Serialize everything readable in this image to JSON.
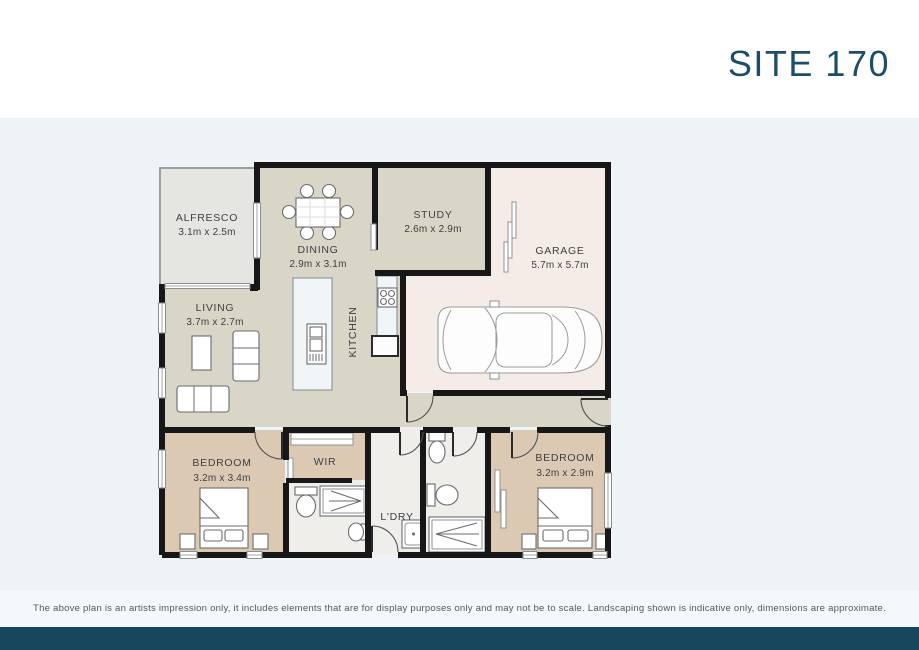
{
  "header": {
    "site_label": "SITE 170"
  },
  "plan": {
    "rooms": [
      {
        "name": "ALFRESCO",
        "dims": "3.1m x 2.5m"
      },
      {
        "name": "DINING",
        "dims": "2.9m x 3.1m"
      },
      {
        "name": "STUDY",
        "dims": "2.6m x 2.9m"
      },
      {
        "name": "GARAGE",
        "dims": "5.7m x 5.7m"
      },
      {
        "name": "LIVING",
        "dims": "3.7m x 2.7m"
      },
      {
        "name": "KITCHEN",
        "dims": ""
      },
      {
        "name": "BEDROOM",
        "dims": "3.2m x 3.4m"
      },
      {
        "name": "WIR",
        "dims": ""
      },
      {
        "name": "L'DRY",
        "dims": ""
      },
      {
        "name": "BEDROOM",
        "dims": "3.2m x 2.9m"
      }
    ]
  },
  "footer": {
    "disclaimer": "The above plan is an artists impression only, it includes elements that are for display purposes only and may not be to scale. Landscaping shown is indicative only, dimensions are approximate."
  },
  "colors": {
    "accent": "#1e4d68",
    "footer_bar": "#16475d",
    "plan_background": "#edf3f6",
    "floor_main": "#d9d5c7",
    "floor_bedroom": "#dcc9b3",
    "floor_garage": "#f5ece7",
    "floor_wet": "#efeeea",
    "floor_alfresco": "#e5e6e2"
  }
}
